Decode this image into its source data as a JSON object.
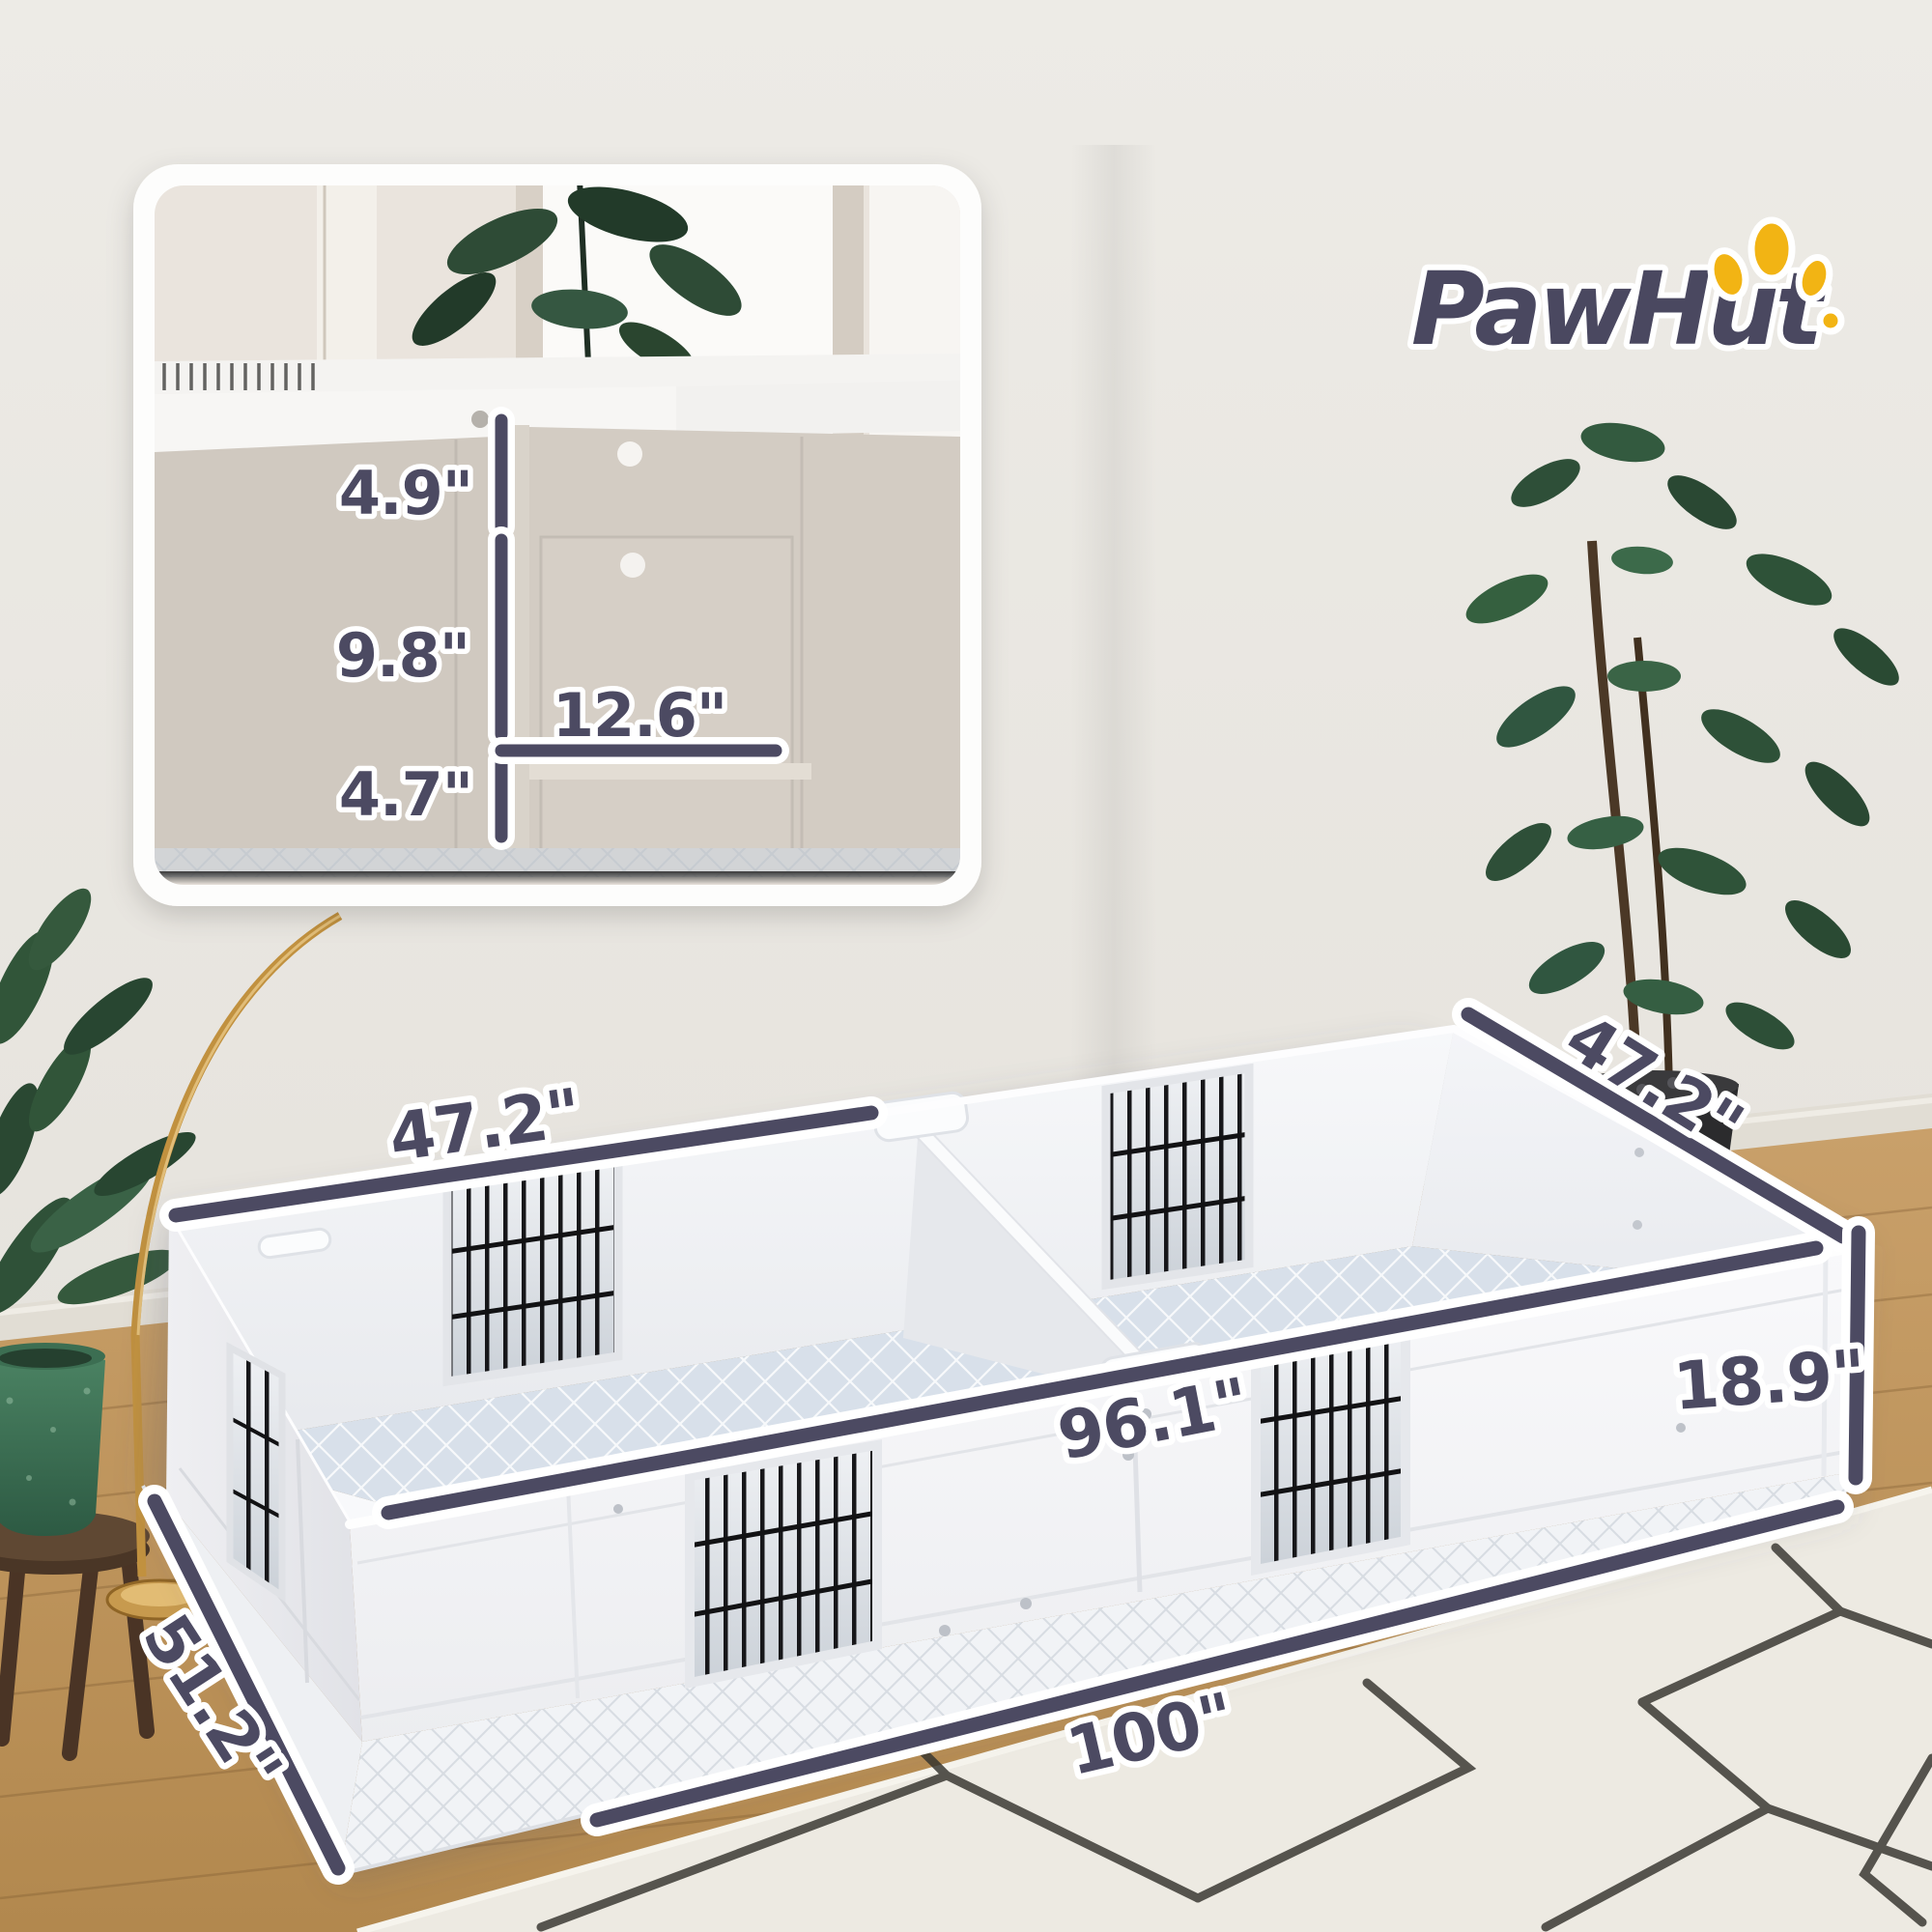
{
  "brand": {
    "name": "PawHut"
  },
  "logo": {
    "text_color": "#4A4860",
    "paw_color": "#F2B414"
  },
  "dimensions": {
    "inset": {
      "top_rail_height": "4.9\"",
      "door_height": "9.8\"",
      "door_width": "12.6\"",
      "bottom_rail_height": "4.7\""
    },
    "main": {
      "left_section_width": "47.2\"",
      "right_section_depth": "47.2\"",
      "inner_length": "96.1\"",
      "wall_height": "18.9\"",
      "outer_length": "100\"",
      "outer_depth": "51.2\""
    }
  },
  "style": {
    "dimension_color": "#4C4A62",
    "dimension_outline": "#FFFFFF"
  }
}
